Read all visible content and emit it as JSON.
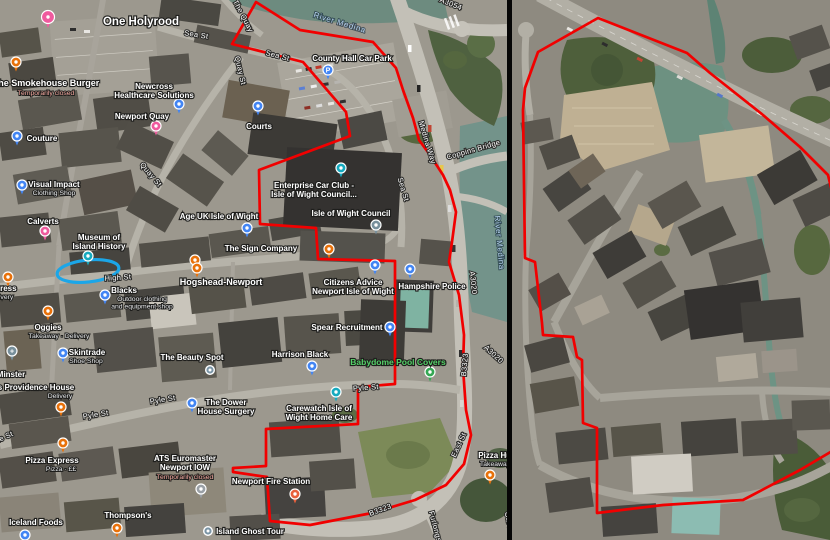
{
  "colors": {
    "boundary": "#f10000",
    "highlight": "#1ba6e8",
    "poi_green_text": "#55d169",
    "closed_text": "#f4a9a0",
    "pins": {
      "orange": "#e8710a",
      "blue": "#4285f4",
      "pink": "#ef5a9e",
      "teal": "#16aabf",
      "civic": "#78909c",
      "green": "#34a853",
      "fire": "#e8603c",
      "gray": "#9aa0a6",
      "dot": "#7b95a6"
    }
  },
  "left_panel": {
    "streets": [
      {
        "t": "The Quay",
        "x": 241,
        "y": 17,
        "r": 62
      },
      {
        "t": "Sea St",
        "x": 196,
        "y": 37,
        "r": 9
      },
      {
        "t": "Sea St",
        "x": 277,
        "y": 58,
        "r": 14
      },
      {
        "t": "Sea St",
        "x": 401,
        "y": 190,
        "r": 73
      },
      {
        "t": "Quay St",
        "x": 238,
        "y": 71,
        "r": 77
      },
      {
        "t": "Quay St",
        "x": 149,
        "y": 176,
        "r": 50
      },
      {
        "t": "High St",
        "x": 118,
        "y": 280,
        "r": -4
      },
      {
        "t": "Pyle St",
        "x": 366,
        "y": 390,
        "r": -4
      },
      {
        "t": "Pyle St",
        "x": 163,
        "y": 402,
        "r": -9
      },
      {
        "t": "Pyle St",
        "x": 96,
        "y": 417,
        "r": -9
      },
      {
        "t": "Pyle St",
        "x": 2,
        "y": 441,
        "r": -25
      },
      {
        "t": "Medina Way",
        "x": 425,
        "y": 143,
        "r": 73
      },
      {
        "t": "Coppins Bridge",
        "x": 474,
        "y": 152,
        "r": -16
      },
      {
        "t": "East St",
        "x": 461,
        "y": 446,
        "r": -65
      },
      {
        "t": "B3323",
        "x": 467,
        "y": 365,
        "r": -85
      },
      {
        "t": "B3323",
        "x": 381,
        "y": 512,
        "r": -20
      },
      {
        "t": "A3020",
        "x": 471,
        "y": 283,
        "r": 84
      },
      {
        "t": "A3020",
        "x": 492,
        "y": 356,
        "r": 42
      },
      {
        "t": "A3054",
        "x": 450,
        "y": 6,
        "r": 22
      },
      {
        "t": "Furlongs",
        "x": 433,
        "y": 527,
        "r": 75
      },
      {
        "t": "Car Park",
        "x": 508,
        "y": 528,
        "r": 78
      }
    ],
    "water_labels": [
      {
        "t": "River Medina",
        "x": 339,
        "y": 25,
        "r": 17
      },
      {
        "t": "River Medina",
        "x": 497,
        "y": 243,
        "r": 85
      }
    ],
    "pois": [
      {
        "id": "one-holyrood",
        "lines": [
          "One Holyrood"
        ],
        "lx": 141,
        "ly": 25,
        "fs": 11.5,
        "pin": {
          "x": 48,
          "y": 17,
          "c": "pink",
          "s": 6.5
        }
      },
      {
        "id": "smokehouse-burger",
        "lines": [
          "The Smokehouse Burger"
        ],
        "closed": "Temporarily closed",
        "lx": 46,
        "ly": 86,
        "fs": 9,
        "pin": {
          "x": 16,
          "y": 62,
          "c": "orange"
        }
      },
      {
        "id": "newcross-healthcare",
        "lines": [
          "Newcross",
          "Healthcare Solutions"
        ],
        "lx": 154,
        "ly": 89,
        "pin": {
          "x": 179,
          "y": 104,
          "c": "blue"
        }
      },
      {
        "id": "newport-quay",
        "lines": [
          "Newport Quay"
        ],
        "lx": 142,
        "ly": 119,
        "pin": {
          "x": 156,
          "y": 126,
          "c": "pink"
        }
      },
      {
        "id": "courts",
        "lines": [
          "Courts"
        ],
        "lx": 259,
        "ly": 129,
        "pin": {
          "x": 258,
          "y": 106,
          "c": "blue"
        }
      },
      {
        "id": "county-hall-car-park",
        "lines": [
          "County Hall Car Park"
        ],
        "lx": 352,
        "ly": 61,
        "pin": {
          "x": 328,
          "y": 70,
          "c": "blue",
          "g": "P"
        }
      },
      {
        "id": "couture",
        "lines": [
          "Couture"
        ],
        "lx": 42,
        "ly": 141,
        "pin": {
          "x": 17,
          "y": 136,
          "c": "blue"
        }
      },
      {
        "id": "visual-impact",
        "lines": [
          "Visual Impact"
        ],
        "sub": [
          "Clothing Shop"
        ],
        "lx": 54,
        "ly": 187,
        "pin": {
          "x": 22,
          "y": 185,
          "c": "blue"
        }
      },
      {
        "id": "calverts",
        "lines": [
          "Calverts"
        ],
        "lx": 43,
        "ly": 224,
        "pin": {
          "x": 45,
          "y": 231,
          "c": "pink"
        }
      },
      {
        "id": "museum-island-history",
        "lines": [
          "Museum of",
          "Island History"
        ],
        "lx": 99,
        "ly": 240,
        "pin": {
          "x": 88,
          "y": 256,
          "c": "teal"
        }
      },
      {
        "id": "age-uk",
        "lines": [
          "Age UK Isle of Wight"
        ],
        "lx": 219,
        "ly": 219,
        "pin": {
          "x": 247,
          "y": 228,
          "c": "blue"
        }
      },
      {
        "id": "sign-company",
        "lines": [
          "The Sign Company"
        ],
        "lx": 261,
        "ly": 251,
        "pin": {
          "x": 195,
          "y": 260,
          "c": "orange"
        }
      },
      {
        "id": "food-poi",
        "lines": [],
        "lx": 0,
        "ly": 0,
        "pin": {
          "x": 329,
          "y": 249,
          "c": "orange"
        }
      },
      {
        "id": "enterprise-car-club",
        "lines": [
          "Enterprise Car Club -",
          "Isle of Wight Council..."
        ],
        "lx": 314,
        "ly": 188,
        "pin": {
          "x": 341,
          "y": 168,
          "c": "teal"
        }
      },
      {
        "id": "iow-council",
        "lines": [
          "Isle of Wight Council"
        ],
        "lx": 351,
        "ly": 216,
        "pin": {
          "x": 376,
          "y": 225,
          "c": "civic"
        }
      },
      {
        "id": "express",
        "lines": [
          "Express"
        ],
        "sub": [
          "Delivery"
        ],
        "lx": 1,
        "ly": 291,
        "pin": {
          "x": 8,
          "y": 277,
          "c": "orange"
        }
      },
      {
        "id": "hogshead-newport",
        "lines": [
          "Hogshead-Newport"
        ],
        "lx": 221,
        "ly": 285,
        "fs": 9,
        "pin": {
          "x": 197,
          "y": 268,
          "c": "orange"
        }
      },
      {
        "id": "blacks",
        "lines": [
          "Blacks"
        ],
        "sub": [
          "Outdoor clothing",
          "and equipment shop"
        ],
        "lx": 124,
        "ly": 293,
        "sx": 142,
        "pin": {
          "x": 105,
          "y": 295,
          "c": "blue"
        }
      },
      {
        "id": "oggies",
        "lines": [
          "Oggies"
        ],
        "sub": [
          "Takeaway · Delivery"
        ],
        "lx": 48,
        "ly": 330,
        "sx": 59,
        "pin": {
          "x": 48,
          "y": 311,
          "c": "orange"
        }
      },
      {
        "id": "skintrade",
        "lines": [
          "Skintrade"
        ],
        "sub": [
          "Shoe Shop"
        ],
        "lx": 87,
        "ly": 355,
        "sx": 86,
        "pin": {
          "x": 63,
          "y": 353,
          "c": "blue"
        }
      },
      {
        "id": "beauty-spot",
        "lines": [
          "The Beauty Spot"
        ],
        "lx": 192,
        "ly": 360,
        "pin": {
          "x": 210,
          "y": 370,
          "c": "dot"
        }
      },
      {
        "id": "minster",
        "lines": [
          "Minster"
        ],
        "lx": 11,
        "ly": 377,
        "pin": {
          "x": 12,
          "y": 351,
          "c": "civic",
          "g": "+"
        }
      },
      {
        "id": "providence-house",
        "lines": [
          "s Providence House"
        ],
        "sub": [
          "Delivery"
        ],
        "lx": 36,
        "ly": 390,
        "sx": 60,
        "pin": {
          "x": 61,
          "y": 407,
          "c": "orange"
        }
      },
      {
        "id": "harrison-black",
        "lines": [
          "Harrison Black"
        ],
        "lx": 300,
        "ly": 357,
        "pin": {
          "x": 312,
          "y": 366,
          "c": "blue"
        }
      },
      {
        "id": "spear-recruitment",
        "lines": [
          "Spear Recruitment"
        ],
        "lx": 347,
        "ly": 330,
        "pin": {
          "x": 390,
          "y": 327,
          "c": "blue"
        }
      },
      {
        "id": "citizens-advice",
        "lines": [
          "Citizens Advice",
          "Newport Isle of Wight"
        ],
        "lx": 353,
        "ly": 285,
        "pin": {
          "x": 375,
          "y": 265,
          "c": "blue"
        }
      },
      {
        "id": "hampshire-police",
        "lines": [
          "Hampshire Police"
        ],
        "lx": 432,
        "ly": 289,
        "pin": {
          "x": 410,
          "y": 269,
          "c": "blue"
        }
      },
      {
        "id": "babydome-pool-covers",
        "lines": [
          "Babydome Pool Covers"
        ],
        "green": true,
        "lx": 398,
        "ly": 365,
        "fs": 8.5,
        "pin": {
          "x": 430,
          "y": 372,
          "c": "green"
        }
      },
      {
        "id": "dower-house-surgery",
        "lines": [
          "The Dower",
          "House Surgery"
        ],
        "lx": 226,
        "ly": 405,
        "pin": {
          "x": 192,
          "y": 403,
          "c": "blue"
        }
      },
      {
        "id": "carewatch",
        "lines": [
          "Carewatch Isle of",
          "Wight Home Care"
        ],
        "lx": 319,
        "ly": 411,
        "pin": {
          "x": 336,
          "y": 392,
          "c": "teal"
        }
      },
      {
        "id": "pizza-express",
        "lines": [
          "Pizza Express"
        ],
        "sub": [
          "Pizza · ££"
        ],
        "lx": 52,
        "ly": 463,
        "sx": 61,
        "pin": {
          "x": 63,
          "y": 443,
          "c": "orange"
        }
      },
      {
        "id": "ats-euromaster",
        "lines": [
          "ATS Euromaster",
          "Newport IOW"
        ],
        "closed": "Temporarily closed",
        "lx": 185,
        "ly": 461,
        "pin": {
          "x": 201,
          "y": 489,
          "c": "gray"
        }
      },
      {
        "id": "newport-fire-station",
        "lines": [
          "Newport Fire Station"
        ],
        "lx": 271,
        "ly": 484,
        "pin": {
          "x": 295,
          "y": 494,
          "c": "fire"
        }
      },
      {
        "id": "thompsons",
        "lines": [
          "Thompson's"
        ],
        "lx": 128,
        "ly": 518,
        "pin": {
          "x": 117,
          "y": 528,
          "c": "orange"
        }
      },
      {
        "id": "iceland-foods",
        "lines": [
          "Iceland Foods"
        ],
        "lx": 36,
        "ly": 525,
        "pin": {
          "x": 25,
          "y": 535,
          "c": "blue"
        }
      },
      {
        "id": "island-ghost-tour",
        "lines": [
          "Island Ghost Tour"
        ],
        "lx": 250,
        "ly": 534,
        "pin": {
          "x": 208,
          "y": 531,
          "c": "dot"
        }
      },
      {
        "id": "pizza-hut",
        "lines": [
          "Pizza Hut"
        ],
        "sub": [
          "Takeaway"
        ],
        "lx": 496,
        "ly": 458,
        "sx": 495,
        "pin": {
          "x": 490,
          "y": 475,
          "c": "orange"
        }
      }
    ],
    "boundary": "256,2 300,30 373,42 396,68 403,90 413,118 419,140 430,155 443,175 450,190 456,212 452,242 449,262 459,295 464,335 463,368 466,410 471,435 464,464 446,485 415,500 372,513 310,525 270,521 267,477 233,472 233,468 266,466 266,429 358,424 358,387 395,384 395,261 318,259 316,228 260,224 259,170 350,136 346,112 303,62 232,44",
    "highlight_ellipse": {
      "cx": 88,
      "cy": 271,
      "rx": 31,
      "ry": 11,
      "rot": -6
    }
  },
  "right_panel": {
    "boundary": "86,18 175,53 198,73 251,115 288,147 316,175 322,200 322,450 288,470 231,500 151,505 85,513 85,428 71,423 70,360 65,357 61,337 31,335 30,323 23,262 13,258 11,110 13,88 26,52"
  }
}
